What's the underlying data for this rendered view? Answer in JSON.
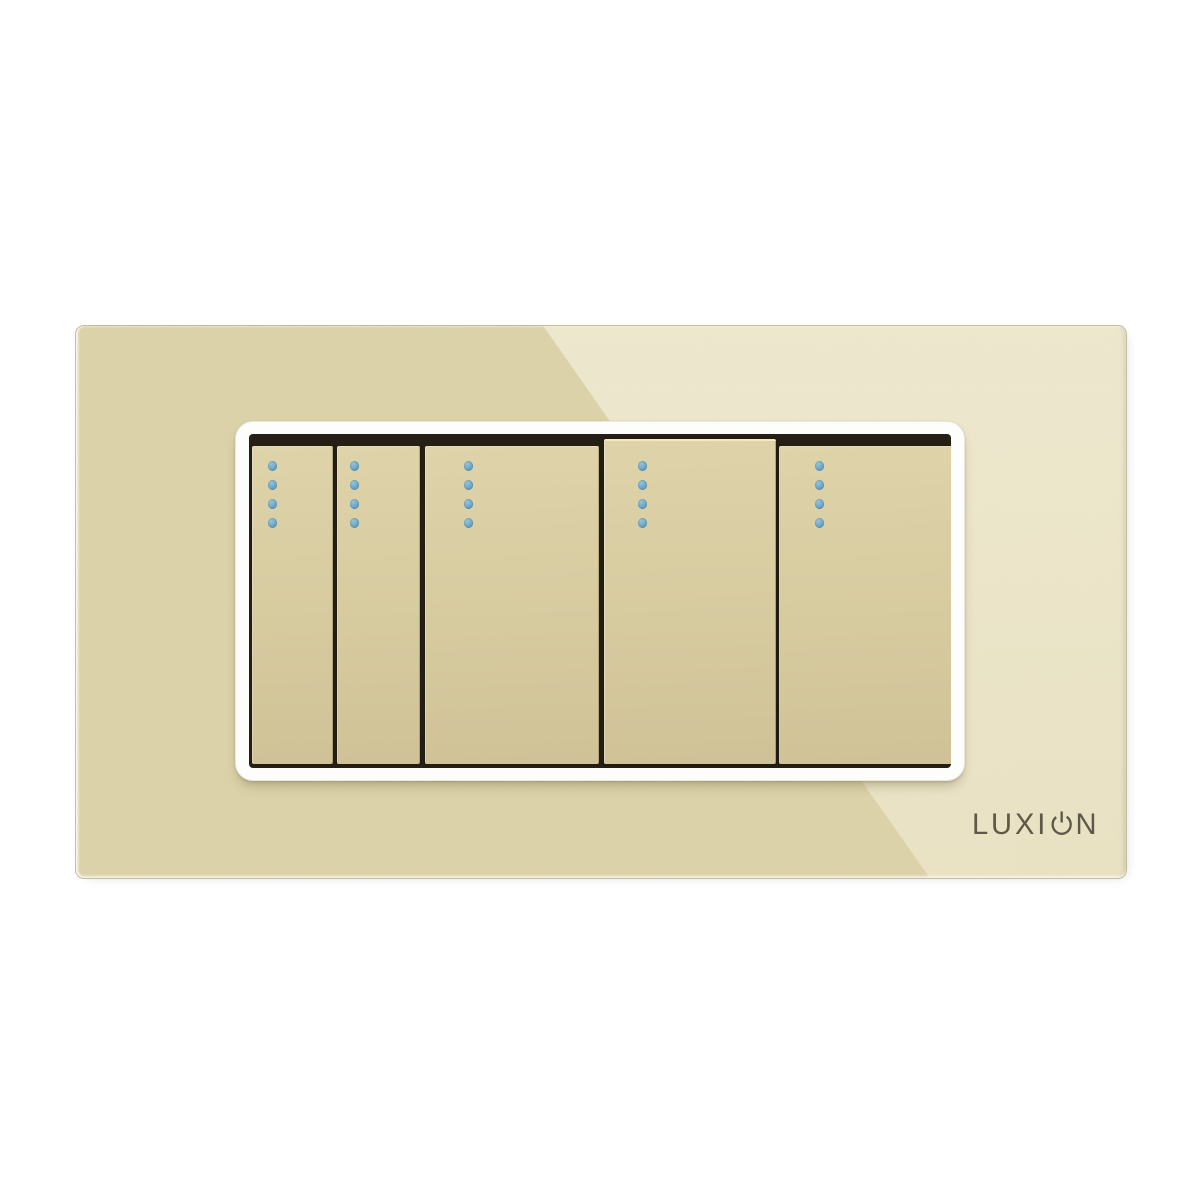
{
  "product": {
    "brand": "LUXION",
    "brand_prefix": "LUXI",
    "brand_suffix": "N",
    "panel": {
      "material": "glass",
      "gang_count": 5,
      "led_dots_per_switch": 4
    },
    "switches": [
      {
        "name": "switch-1",
        "width": "narrow",
        "led_count": 4,
        "raised": false
      },
      {
        "name": "switch-2",
        "width": "narrow",
        "led_count": 4,
        "raised": false
      },
      {
        "name": "switch-3",
        "width": "wide",
        "led_count": 4,
        "raised": false
      },
      {
        "name": "switch-4",
        "width": "wide",
        "led_count": 4,
        "raised": true
      },
      {
        "name": "switch-5",
        "width": "wide",
        "led_count": 4,
        "raised": false
      }
    ],
    "colors": {
      "page_background": "#ffffff",
      "glass": "#ddd3aa",
      "glass_highlight": "#e9e2c7",
      "frame": "#fdfdfc",
      "well": "#261f15",
      "switch": "#d8cca1",
      "led": "#6ba6c6",
      "logo": "#524d3e"
    }
  }
}
